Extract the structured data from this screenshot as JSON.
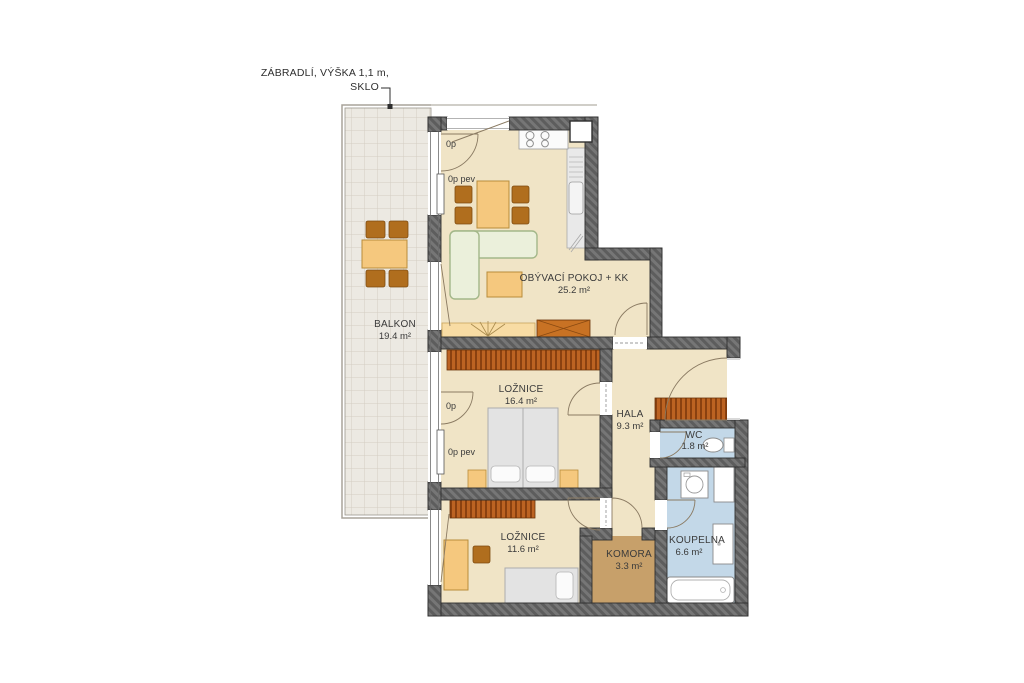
{
  "annotation": {
    "line1": "ZÁBRADLÍ, VÝŠKA 1,1 m,",
    "line2": "SKLO"
  },
  "rooms": [
    {
      "id": "balkon",
      "name": "BALKON",
      "area": "19.4 m²"
    },
    {
      "id": "obyvaci",
      "name": "OBÝVACÍ POKOJ + KK",
      "area": "25.2 m²"
    },
    {
      "id": "loznice1",
      "name": "LOŽNICE",
      "area": "16.4 m²"
    },
    {
      "id": "hala",
      "name": "HALA",
      "area": "9.3 m²"
    },
    {
      "id": "wc",
      "name": "WC",
      "area": "1.8 m²"
    },
    {
      "id": "loznice2",
      "name": "LOŽNICE",
      "area": "11.6 m²"
    },
    {
      "id": "komora",
      "name": "KOMORA",
      "area": "3.3 m²"
    },
    {
      "id": "koupelna",
      "name": "KOUPELNA",
      "area": "6.6 m²"
    }
  ],
  "windows": {
    "lr_door": "0p",
    "lr_fixed": "0p pev",
    "br_door": "0p",
    "br_fixed": "0p pev"
  },
  "colors": {
    "floor": "#F0E4C6",
    "wet_floor": "#C3D8E8",
    "storage_floor": "#C7A06A",
    "balcony_tile": "#ECE9E2",
    "wall": "#767676",
    "wood": "#F5C87E",
    "chair": "#B06E1E",
    "wardrobe": "#BC6322",
    "sofa": "#EBF0DB",
    "bed": "#E3E3E3",
    "text": "#3B3B3B"
  }
}
